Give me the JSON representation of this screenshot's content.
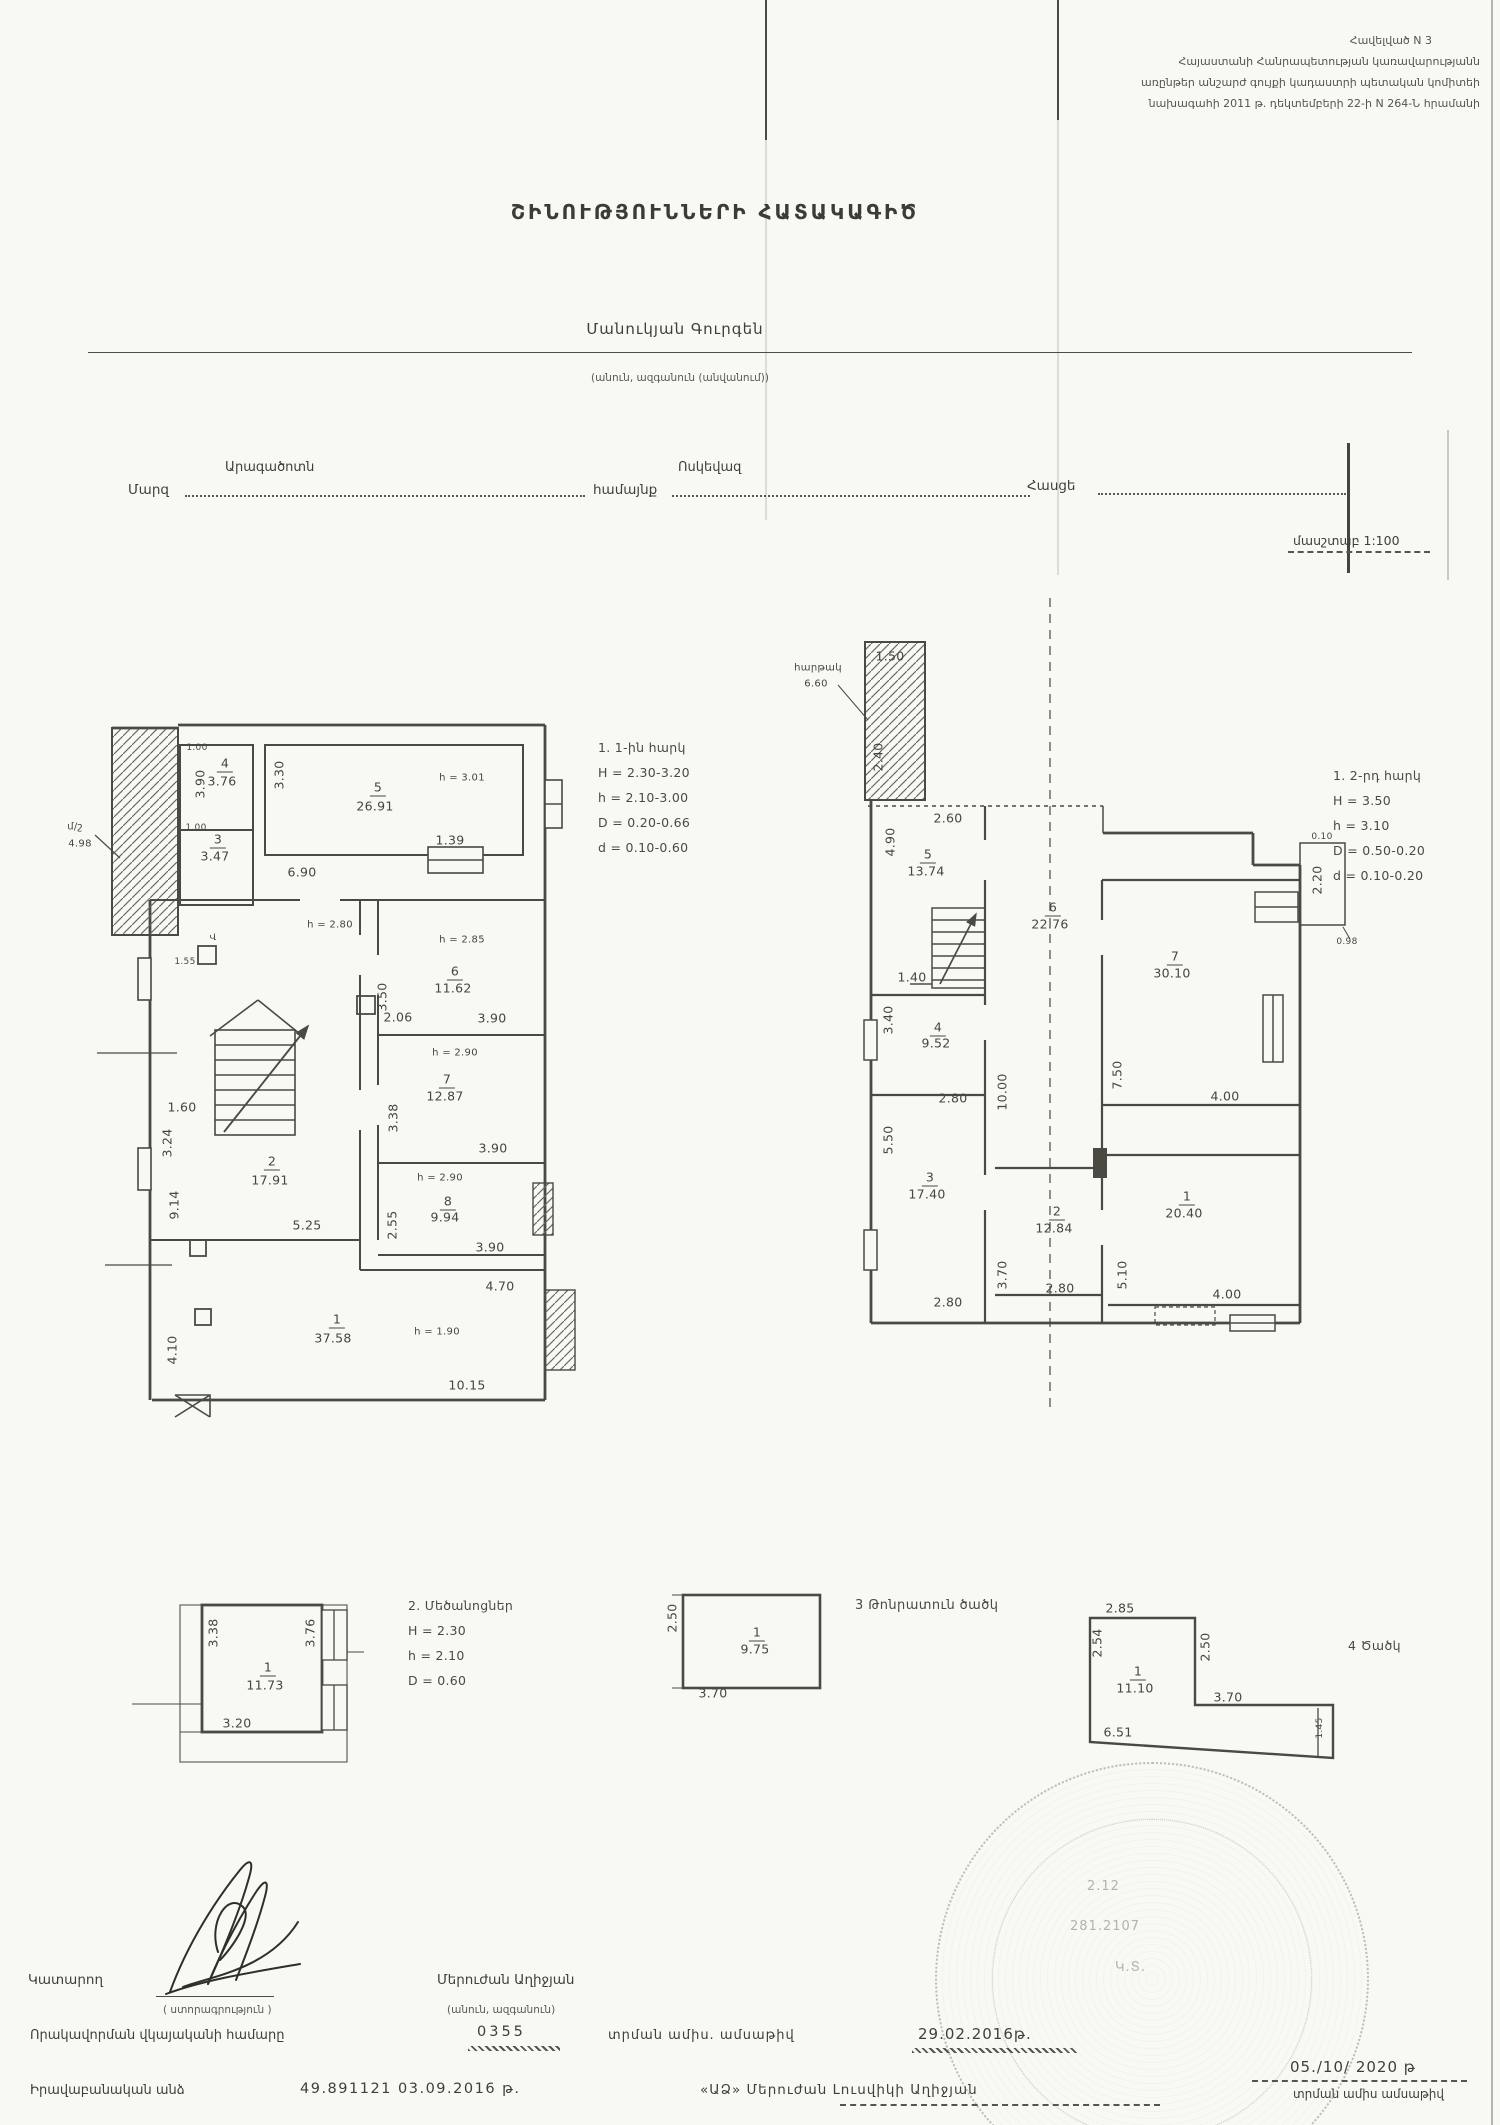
{
  "header": {
    "lines": [
      "Հավելված N 3",
      "Հայաստանի Հանրապետության կառավարությանն",
      "առընթեր անշարժ գույքի կադաստրի պետական կոմիտեի",
      "նախագահի 2011 թ. դեկտեմբերի 22-ի N 264-Ն հրամանի"
    ]
  },
  "title": "ՇԻՆՈՒԹՅՈՒՆՆԵՐԻ ՀԱՏԱԿԱԳԻԾ",
  "owner": {
    "name": "Մանուկյան Գուրգեն",
    "caption": "(անուն, ազգանուն (անվանում))"
  },
  "form": {
    "region_label": "Մարզ",
    "region_value": "Արագածոտն",
    "community_label": "համայնք",
    "community_value": "Ոսկեվազ",
    "address_label": "Հասցե",
    "scale": "մասշտաբ 1:100"
  },
  "left_plan": {
    "notes": [
      "1. 1-ին հարկ",
      "H = 2.30-3.20",
      "h = 2.10-3.00",
      "D = 0.20-0.66",
      "d = 0.10-0.60"
    ],
    "labels": [
      {
        "t": "մ/շ",
        "x": 15,
        "y": 127,
        "s": 10
      },
      {
        "t": "4.98",
        "x": 20,
        "y": 144,
        "s": 10
      },
      {
        "t": "1.00",
        "x": 137,
        "y": 48,
        "s": 9
      },
      {
        "t": "3.90",
        "x": 140,
        "y": 84,
        "r": -90
      },
      {
        "t": "4",
        "x": 165,
        "y": 64,
        "u": 1
      },
      {
        "t": "3.76",
        "x": 162,
        "y": 81
      },
      {
        "t": "1.00",
        "x": 136,
        "y": 128,
        "s": 9
      },
      {
        "t": "3",
        "x": 158,
        "y": 140,
        "u": 1
      },
      {
        "t": "3.47",
        "x": 155,
        "y": 156
      },
      {
        "t": "3.30",
        "x": 219,
        "y": 75,
        "r": -90
      },
      {
        "t": "5",
        "x": 318,
        "y": 88,
        "u": 1
      },
      {
        "t": "26.91",
        "x": 315,
        "y": 106
      },
      {
        "t": "h = 3.01",
        "x": 402,
        "y": 78,
        "s": 10
      },
      {
        "t": "6.90",
        "x": 242,
        "y": 172
      },
      {
        "t": "1.39",
        "x": 390,
        "y": 140
      },
      {
        "t": "h = 2.80",
        "x": 270,
        "y": 225,
        "s": 10
      },
      {
        "t": "Վ",
        "x": 153,
        "y": 238,
        "s": 9
      },
      {
        "t": "1.55",
        "x": 125,
        "y": 262,
        "s": 9
      },
      {
        "t": "2.06",
        "x": 338,
        "y": 317
      },
      {
        "t": "h = 2.85",
        "x": 402,
        "y": 240,
        "s": 10
      },
      {
        "t": "6",
        "x": 395,
        "y": 272,
        "u": 1
      },
      {
        "t": "11.62",
        "x": 393,
        "y": 288
      },
      {
        "t": "3.50",
        "x": 322,
        "y": 297,
        "r": -90
      },
      {
        "t": "3.90",
        "x": 432,
        "y": 318
      },
      {
        "t": "1.60",
        "x": 122,
        "y": 407
      },
      {
        "t": "3.24",
        "x": 107,
        "y": 443,
        "r": -90
      },
      {
        "t": "2",
        "x": 212,
        "y": 462,
        "u": 1
      },
      {
        "t": "17.91",
        "x": 210,
        "y": 480
      },
      {
        "t": "h = 2.90",
        "x": 395,
        "y": 353,
        "s": 10
      },
      {
        "t": "7",
        "x": 387,
        "y": 380,
        "u": 1
      },
      {
        "t": "12.87",
        "x": 385,
        "y": 396
      },
      {
        "t": "3.38",
        "x": 333,
        "y": 418,
        "r": -90
      },
      {
        "t": "3.90",
        "x": 433,
        "y": 448
      },
      {
        "t": "9.14",
        "x": 114,
        "y": 505,
        "r": -90
      },
      {
        "t": "5.25",
        "x": 247,
        "y": 525
      },
      {
        "t": "h = 2.90",
        "x": 380,
        "y": 478,
        "s": 10
      },
      {
        "t": "8",
        "x": 388,
        "y": 502,
        "u": 1
      },
      {
        "t": "9.94",
        "x": 385,
        "y": 517
      },
      {
        "t": "2.55",
        "x": 332,
        "y": 525,
        "r": -90
      },
      {
        "t": "3.90",
        "x": 430,
        "y": 547
      },
      {
        "t": "4.70",
        "x": 440,
        "y": 586
      },
      {
        "t": "1",
        "x": 277,
        "y": 620,
        "u": 1
      },
      {
        "t": "37.58",
        "x": 273,
        "y": 638
      },
      {
        "t": "h = 1.90",
        "x": 377,
        "y": 632,
        "s": 10
      },
      {
        "t": "4.10",
        "x": 112,
        "y": 650,
        "r": -90
      },
      {
        "t": "10.15",
        "x": 407,
        "y": 685
      }
    ]
  },
  "right_plan": {
    "notes": [
      "1. 2-րդ հարկ",
      "H = 3.50",
      "h = 3.10",
      "D = 0.50-0.20",
      "d = 0.10-0.20"
    ],
    "labels": [
      {
        "t": "հարթակ",
        "x": 28,
        "y": 78,
        "s": 10
      },
      {
        "t": "6.60",
        "x": 26,
        "y": 94,
        "s": 10
      },
      {
        "t": "1.50",
        "x": 100,
        "y": 66
      },
      {
        "t": "2.40",
        "x": 88,
        "y": 167,
        "r": -90
      },
      {
        "t": "2.60",
        "x": 158,
        "y": 228
      },
      {
        "t": "4.90",
        "x": 100,
        "y": 252,
        "r": -90
      },
      {
        "t": "5",
        "x": 138,
        "y": 265,
        "u": 1
      },
      {
        "t": "13.74",
        "x": 136,
        "y": 281
      },
      {
        "t": "1.40",
        "x": 122,
        "y": 387
      },
      {
        "t": "3.40",
        "x": 98,
        "y": 430,
        "r": -90
      },
      {
        "t": "4",
        "x": 148,
        "y": 438,
        "u": 1
      },
      {
        "t": "9.52",
        "x": 146,
        "y": 453
      },
      {
        "t": "2.80",
        "x": 163,
        "y": 508
      },
      {
        "t": "10.00",
        "x": 212,
        "y": 502,
        "r": -90
      },
      {
        "t": "6",
        "x": 263,
        "y": 318,
        "u": 1
      },
      {
        "t": "22.76",
        "x": 260,
        "y": 334
      },
      {
        "t": "7",
        "x": 385,
        "y": 367,
        "u": 1
      },
      {
        "t": "30.10",
        "x": 382,
        "y": 383
      },
      {
        "t": "7.50",
        "x": 327,
        "y": 485,
        "r": -90
      },
      {
        "t": "4.00",
        "x": 435,
        "y": 506
      },
      {
        "t": "0.10",
        "x": 532,
        "y": 247,
        "s": 9
      },
      {
        "t": "2.20",
        "x": 527,
        "y": 290,
        "r": -90
      },
      {
        "t": "0.98",
        "x": 557,
        "y": 352,
        "s": 9
      },
      {
        "t": "5.50",
        "x": 98,
        "y": 550,
        "r": -90
      },
      {
        "t": "3",
        "x": 140,
        "y": 588,
        "u": 1
      },
      {
        "t": "17.40",
        "x": 137,
        "y": 604
      },
      {
        "t": "2.80",
        "x": 158,
        "y": 712
      },
      {
        "t": "2",
        "x": 267,
        "y": 622,
        "u": 1
      },
      {
        "t": "12.84",
        "x": 264,
        "y": 638
      },
      {
        "t": "3.70",
        "x": 212,
        "y": 685,
        "r": -90
      },
      {
        "t": "2.80",
        "x": 270,
        "y": 698
      },
      {
        "t": "1",
        "x": 397,
        "y": 607,
        "u": 1
      },
      {
        "t": "20.40",
        "x": 394,
        "y": 623
      },
      {
        "t": "5.10",
        "x": 332,
        "y": 685,
        "r": -90
      },
      {
        "t": "4.00",
        "x": 437,
        "y": 704
      }
    ]
  },
  "outbuilding": {
    "notes": [
      "2. Մեծանոցներ",
      "H = 2.30",
      "h = 2.10",
      "D = 0.60"
    ],
    "labels": [
      {
        "t": "3.38",
        "x": 83,
        "y": 53,
        "r": -90
      },
      {
        "t": "3.76",
        "x": 180,
        "y": 53,
        "r": -90
      },
      {
        "t": "1",
        "x": 138,
        "y": 88,
        "u": 1
      },
      {
        "t": "11.73",
        "x": 135,
        "y": 105
      },
      {
        "t": "3.20",
        "x": 107,
        "y": 143
      }
    ]
  },
  "tonir": {
    "caption": "3 Թոնրատուն ծածկ",
    "labels": [
      {
        "t": "2.50",
        "x": 12,
        "y": 38,
        "r": -90
      },
      {
        "t": "1",
        "x": 97,
        "y": 53,
        "u": 1
      },
      {
        "t": "9.75",
        "x": 95,
        "y": 69
      },
      {
        "t": "3.70",
        "x": 53,
        "y": 113
      }
    ]
  },
  "canopy": {
    "caption": "4 Ծածկ",
    "labels": [
      {
        "t": "2.85",
        "x": 40,
        "y": 28
      },
      {
        "t": "2.54",
        "x": 17,
        "y": 63,
        "r": -90
      },
      {
        "t": "2.50",
        "x": 125,
        "y": 67,
        "r": -90
      },
      {
        "t": "1",
        "x": 58,
        "y": 92,
        "u": 1
      },
      {
        "t": "11.10",
        "x": 55,
        "y": 108
      },
      {
        "t": "3.70",
        "x": 148,
        "y": 117
      },
      {
        "t": "6.51",
        "x": 38,
        "y": 152
      },
      {
        "t": "1.45",
        "x": 240,
        "y": 148,
        "r": -90,
        "s": 9
      }
    ]
  },
  "stamp": {
    "t1": "2.12",
    "t2": "281.2107",
    "t3": "Կ.Տ."
  },
  "footer": {
    "performer_label": "Կատարող",
    "signature_caption": "( ստորագրություն )",
    "executor_name": "Մերուժան Աղիջյան",
    "executor_caption": "(անուն, ազգանուն)",
    "cert_label": "Որակավորման վկայականի համարը",
    "cert_number": "0355",
    "issue_label": "տրման ամիս. ամսաթիվ",
    "issue_date": "29.02.2016թ.",
    "legal_label": "Իրավաբանական անձ",
    "legal_number": "49.891121 03.09.2016 թ.",
    "legal_name": "«ԱՁ» Մերուժան Լուսվիկի Աղիջյան",
    "right_date": "05./10/ 2020 թ",
    "right_caption": "տրման ամիս ամսաթիվ"
  }
}
